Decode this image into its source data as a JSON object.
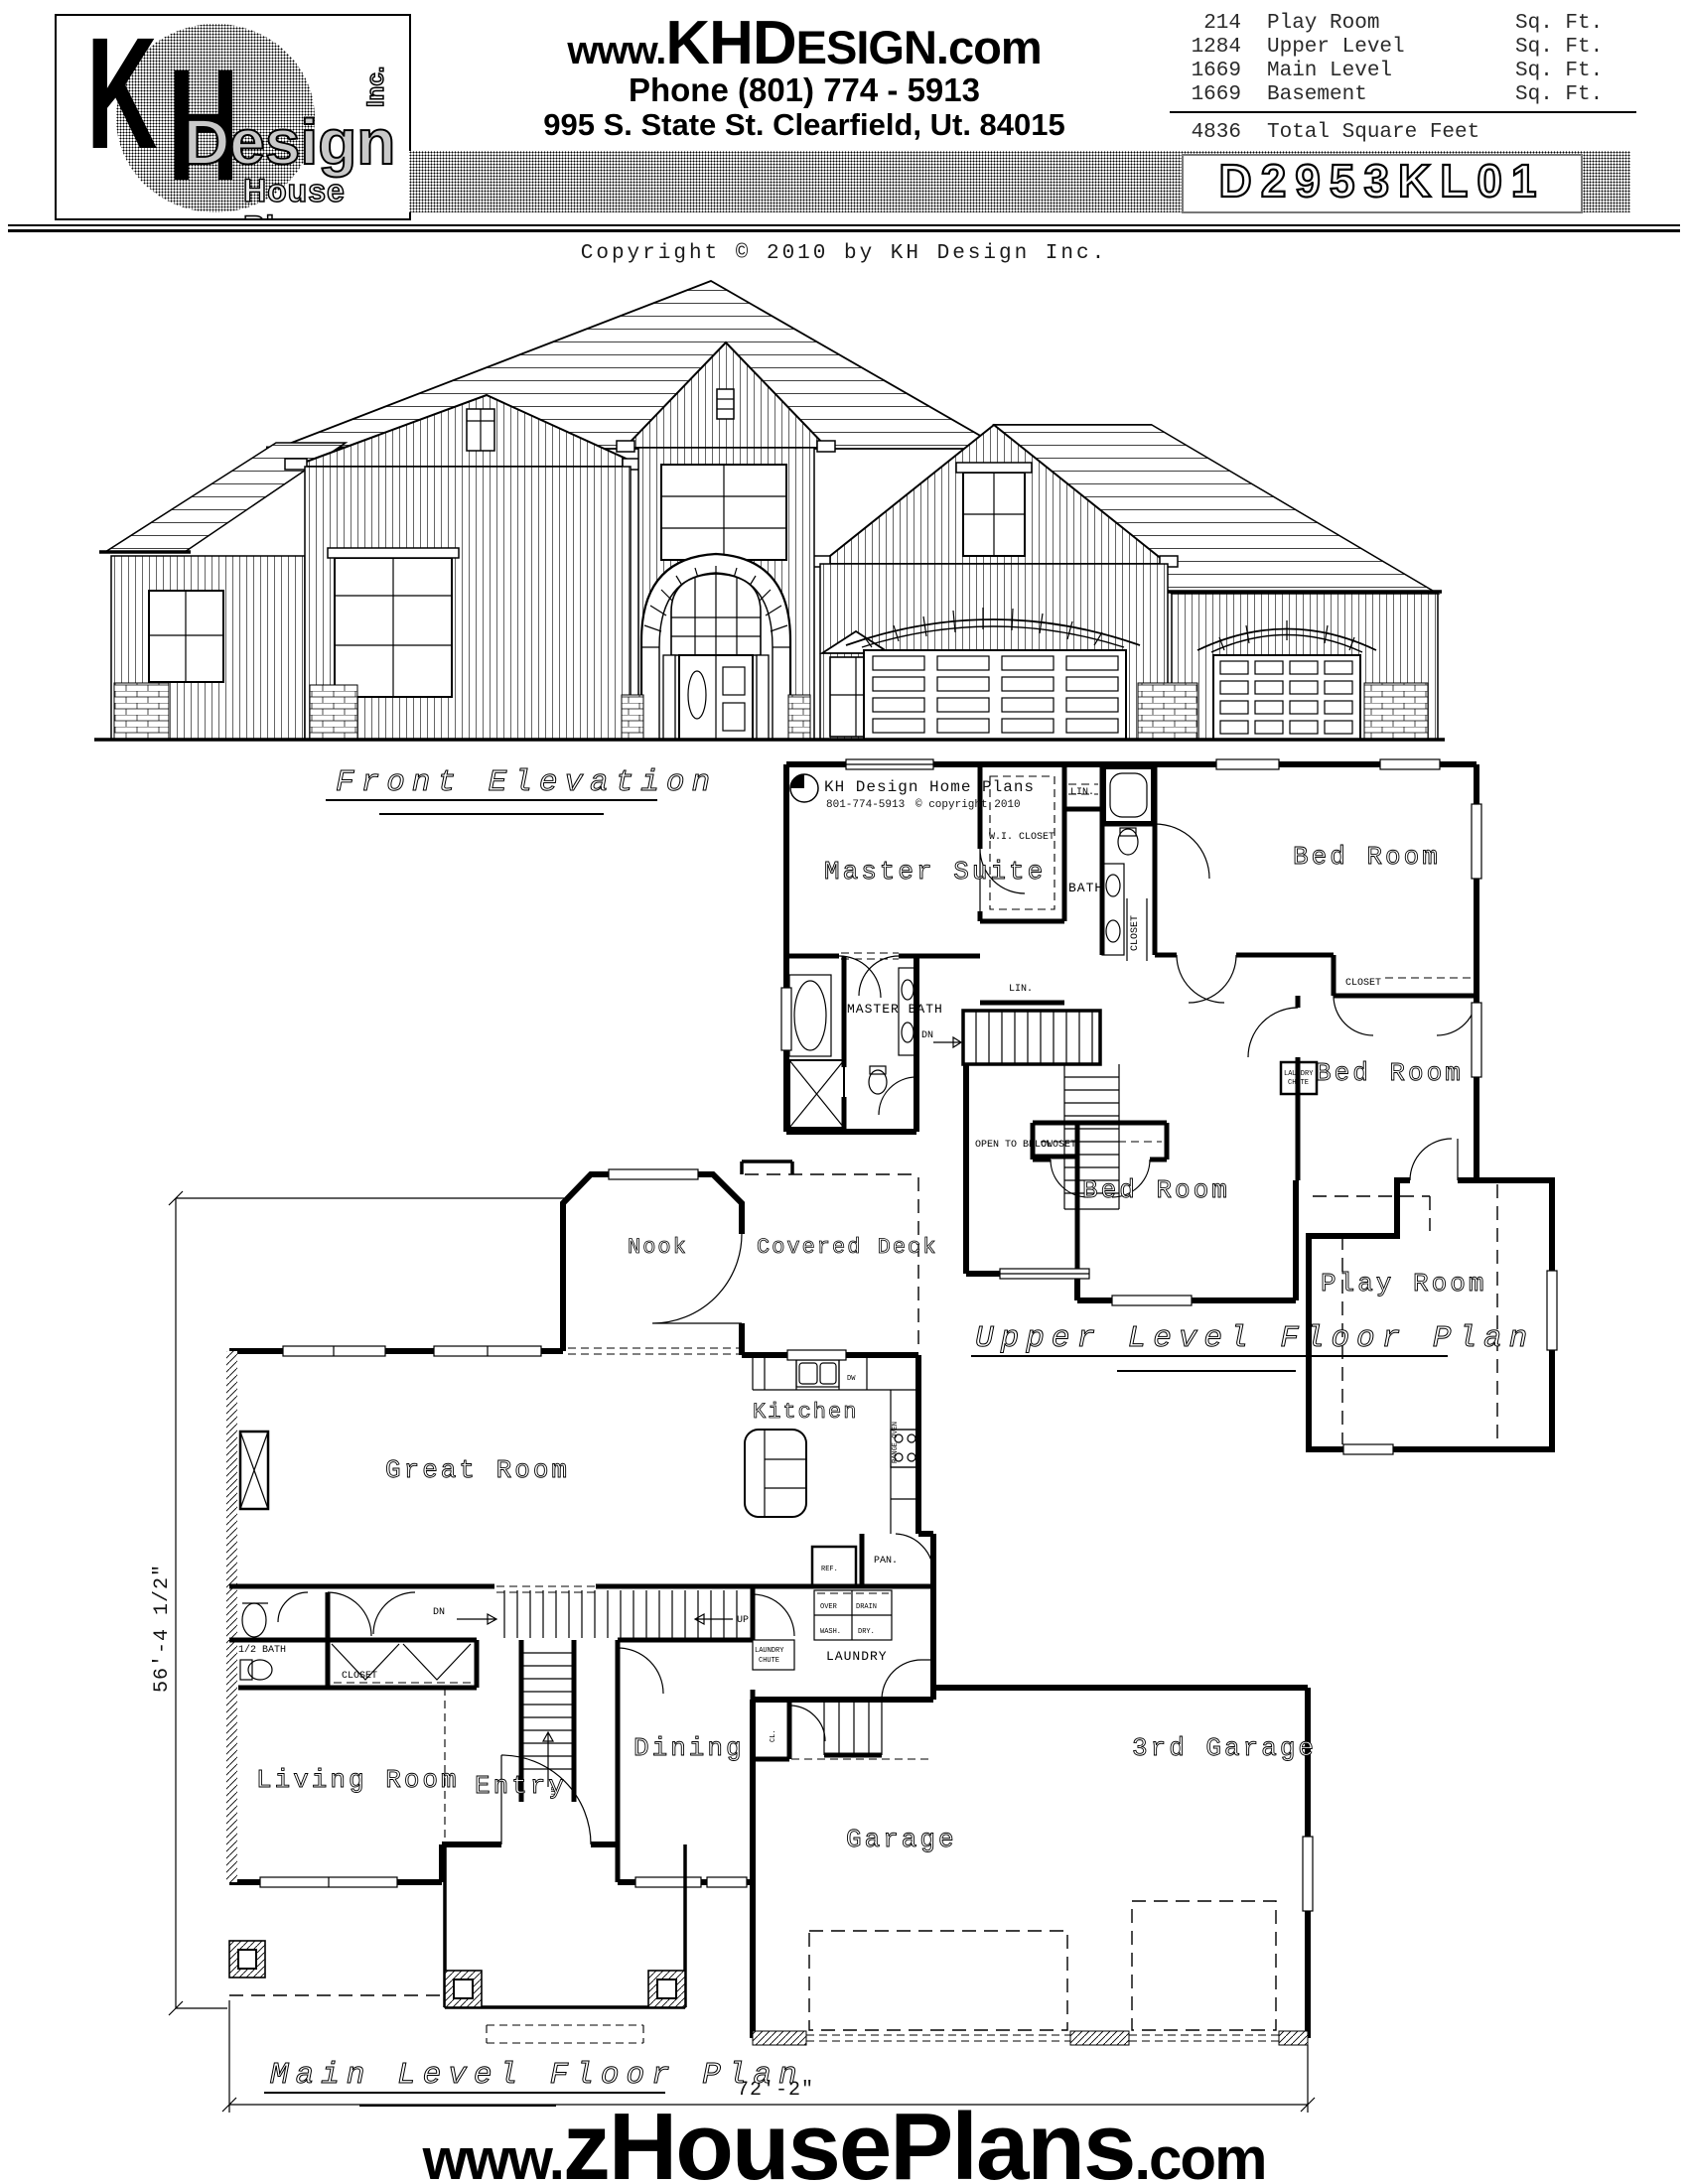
{
  "header": {
    "logo": {
      "k": "K",
      "h": "H",
      "design": "Design",
      "inc": "Inc.",
      "tagline": "House Plans"
    },
    "website": {
      "p1": "www.",
      "p2": "KHD",
      "p3": "ESIGN",
      "p4": ".com"
    },
    "phone": "Phone (801) 774 - 5913",
    "address": "995 S. State St.   Clearfield, Ut. 84015",
    "sqft": {
      "rows": [
        {
          "v": "214",
          "label": "Play Room",
          "unit": "Sq. Ft."
        },
        {
          "v": "1284",
          "label": "Upper Level",
          "unit": "Sq. Ft."
        },
        {
          "v": "1669",
          "label": "Main Level",
          "unit": "Sq. Ft."
        },
        {
          "v": "1669",
          "label": "Basement",
          "unit": "Sq. Ft."
        }
      ],
      "total_value": "4836",
      "total_label": "Total Square Feet"
    },
    "plan_number": "D2953KL01"
  },
  "copyright": "Copyright © 2010  by KH Design Inc.",
  "elevation": {
    "title": "Front Elevation"
  },
  "upper": {
    "title": "Upper Level Floor Plan",
    "logo_title": "KH Design Home Plans",
    "logo_phone": "801-774-5913",
    "logo_copy": "© copyright 2010",
    "master": "Master Suite",
    "wic": "W.I. CLOSET",
    "lin": "LIN.",
    "bath": "BATH",
    "closet": "CLOSET",
    "bed": "Bed Room",
    "mbath": "MASTER BATH",
    "dn": "DN",
    "open": "OPEN TO BELOW",
    "chute1": "LAUNDRY",
    "chute2": "CHUTE",
    "play": "Play Room"
  },
  "main": {
    "title": "Main Level Floor Plan",
    "nook": "Nook",
    "deck": "Covered Deck",
    "kitchen": "Kitchen",
    "dw": "DW",
    "range": "RANGE OVEN",
    "great": "Great Room",
    "ref": "REF.",
    "pan": "PAN.",
    "dn": "DN",
    "up": "UP",
    "over": "OVER",
    "drain": "DRAIN",
    "wash": "WASH.",
    "dry": "DRY.",
    "laundry": "LAUNDRY",
    "chute1": "LAUNDRY",
    "chute2": "CHUTE",
    "cl": "CL.",
    "halfbath": "1/2 BATH",
    "closet": "CLOSET",
    "living": "Living Room",
    "entry": "Entry",
    "dining": "Dining",
    "garage": "Garage",
    "garage3": "3rd Garage",
    "dim_h": "56'-4 1/2\"",
    "dim_w": "72'-2\""
  },
  "footer": {
    "p1": "www.",
    "p2": "zHousePlans",
    "p3": ".com"
  }
}
